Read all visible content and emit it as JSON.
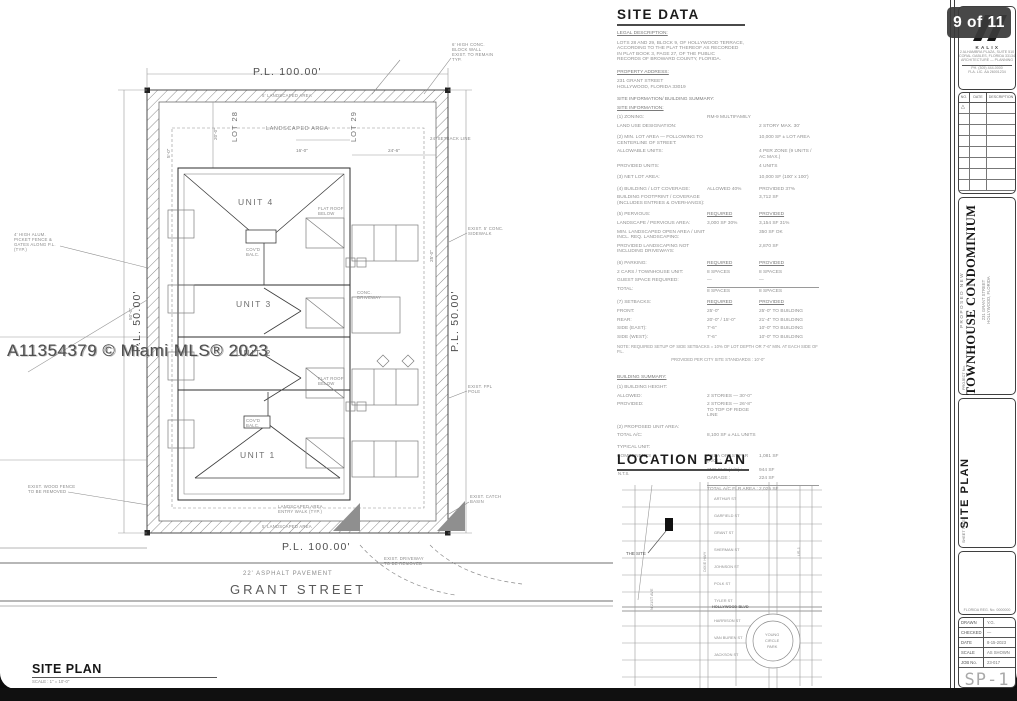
{
  "page": {
    "badge_label": "9 of 11",
    "watermark": "A11354379 © Miami MLS® 2023"
  },
  "site_plan": {
    "title": "SITE PLAN",
    "scale_note": "SCALE : 1\" = 10'-0\"",
    "pl_top": "P.L. 100.00'",
    "pl_bottom": "P.L. 100.00'",
    "pl_left": "P.L. 50.00'",
    "pl_right": "P.L. 50.00'",
    "lot_left": "LOT 28",
    "lot_right": "LOT 29",
    "landscaped_area_label": "LANDSCAPED AREA",
    "landscaped_top": "5' LANDSCAPED AREA",
    "landscaped_bottom": "5' LANDSCAPED AREA",
    "unit_labels": [
      "UNIT 4",
      "UNIT 3",
      "UNIT 2",
      "UNIT 1"
    ],
    "pavement_label": "22' ASPHALT PAVEMENT",
    "street_name": "GRANT STREET",
    "dimensions": [
      {
        "x": 213,
        "y": 140,
        "rot": -90,
        "t": "20'-0\""
      },
      {
        "x": 166,
        "y": 158,
        "rot": -90,
        "t": "5'-0\""
      },
      {
        "x": 388,
        "y": 148,
        "rot": 0,
        "t": "24'-6\""
      },
      {
        "x": 296,
        "y": 148,
        "rot": 0,
        "t": "16'-0\""
      },
      {
        "x": 429,
        "y": 262,
        "rot": -90,
        "t": "25'-0\""
      },
      {
        "x": 128,
        "y": 320,
        "rot": -90,
        "t": "50'-0\""
      }
    ],
    "annotations": [
      {
        "x": 452,
        "y": 42,
        "lines": [
          "6' HIGH CONC.",
          "BLOCK WALL",
          "EXIST. TO REMAIN",
          "TYP."
        ],
        "ldr": [
          451,
          58,
          424,
          94
        ]
      },
      {
        "x": 14,
        "y": 232,
        "lines": [
          "4' HIGH ALUM.",
          "PICKET FENCE &",
          "GATES ALONG P.L.",
          "(TYP.)"
        ],
        "ldr": [
          60,
          246,
          148,
          268
        ]
      },
      {
        "x": 468,
        "y": 226,
        "lines": [
          "EXIST. 5' CONC.",
          "SIDEWALK"
        ],
        "ldr": [
          467,
          233,
          449,
          242
        ]
      },
      {
        "x": 468,
        "y": 384,
        "lines": [
          "EXIST. FPL",
          "POLE"
        ],
        "ldr": [
          467,
          391,
          449,
          398
        ]
      },
      {
        "x": 470,
        "y": 494,
        "lines": [
          "EXIST. CATCH",
          "BASIN"
        ],
        "ldr": [
          469,
          502,
          449,
          514
        ]
      },
      {
        "x": 384,
        "y": 556,
        "lines": [
          "EXIST. DRIVEWAY",
          "TO BE REMOVED"
        ]
      },
      {
        "x": 278,
        "y": 504,
        "lines": [
          "LANDSCAPED AREA",
          "ENTRY WALK (TYP.)"
        ]
      },
      {
        "x": 357,
        "y": 290,
        "lines": [
          "CONC.",
          "DRIVEWAY"
        ]
      },
      {
        "x": 318,
        "y": 206,
        "lines": [
          "FLAT ROOF",
          "BELOW"
        ]
      },
      {
        "x": 318,
        "y": 376,
        "lines": [
          "FLAT ROOF",
          "BELOW"
        ]
      },
      {
        "x": 430,
        "y": 136,
        "lines": [
          "24' SETBACK LINE"
        ]
      },
      {
        "x": 246,
        "y": 247,
        "lines": [
          "COV'D",
          "BALC."
        ]
      },
      {
        "x": 246,
        "y": 418,
        "lines": [
          "COV'D",
          "BALC."
        ]
      },
      {
        "x": 28,
        "y": 484,
        "lines": [
          "EXIST. WOOD FENCE",
          "TO BE REMOVED"
        ],
        "ldr": [
          68,
          492,
          148,
          505
        ]
      }
    ]
  },
  "site_data": {
    "header": "SITE DATA",
    "legal_title": "LEGAL DESCRIPTION:",
    "legal_lines": [
      "LOTS 28 AND 29, BLOCK 9, OF HOLLYWOOD TERRACE,",
      "ACCORDING TO THE PLAT THEREOF AS RECORDED",
      "IN PLAT BOOK 3, PAGE 27, OF THE PUBLIC",
      "RECORDS OF BROWARD COUNTY, FLORIDA."
    ],
    "address_title": "PROPERTY ADDRESS:",
    "address_lines": [
      "231 GRANT STREET",
      "HOLLYWOOD, FLORIDA 33019"
    ],
    "summary_title": "SITE INFORMATION/ BUILDING SUMMARY:",
    "info_title": "SITE INFORMATION:",
    "rows": [
      {
        "l": "(1)  ZONING:",
        "m": "RM-9 MULTIFAMILY",
        "r": ""
      },
      {
        "l": "       LAND USE DESIGNATION:",
        "m": "",
        "r": "2 STORY MAX. 30'"
      },
      {
        "l": "(2)  MIN. LOT AREA — FOLLOWING TO CENTERLINE OF STREET:",
        "m": "",
        "r": "10,000 SF ± LOT AREA",
        "cls": "gap"
      },
      {
        "l": "       ALLOWABLE UNITS:",
        "m": "",
        "r": "4 PER ZONE (9 UNITS / AC MAX.)"
      },
      {
        "l": "       PROVIDED UNITS:",
        "m": "",
        "r": "4 UNITS"
      },
      {
        "l": "(3)  NET LOT AREA:",
        "m": "",
        "r": "10,000 SF  (100' x 100')",
        "cls": "gap"
      },
      {
        "l": "(4)  BUILDING / LOT COVERAGE:",
        "m": "ALLOWED  40%",
        "r": "PROVIDED  37%",
        "cls": "gap"
      },
      {
        "l": "       BUILDING FOOTPRINT / COVERAGE (INCLUDES ENTRIES & OVERHANGS):",
        "m": "",
        "r": "3,712 SF"
      },
      {
        "l": "(5)  PERVIOUS:",
        "m": "REQUIRED",
        "r": "PROVIDED",
        "cls": "hdr gap"
      },
      {
        "l": "       LANDSCAPE / PERVIOUS AREA:",
        "m": "3,000 SF  30%",
        "r": "3,154 SF  31%"
      },
      {
        "l": "       MIN. LANDSCAPED OPEN AREA / UNIT INCL. REQ. LANDSCAPING:",
        "m": "",
        "r": "350 SF   OK"
      },
      {
        "l": "       PROVIDED LANDSCAPING NOT INCLUDING DRIVEWAYS:",
        "m": "",
        "r": "2,870 SF"
      },
      {
        "l": "(6)  PARKING:",
        "m": "REQUIRED",
        "r": "PROVIDED",
        "cls": "hdr gap"
      },
      {
        "l": "       2 CARS / TOWNHOUSE UNIT:",
        "m": "8 SPACES",
        "r": "8 SPACES"
      },
      {
        "l": "       GUEST SPACE REQUIRED:",
        "m": "—",
        "r": "—"
      },
      {
        "l": "       TOTAL:",
        "m": "8 SPACES",
        "r": "8 SPACES",
        "cls": "tot"
      },
      {
        "l": "(7)  SETBACKS:",
        "m": "REQUIRED",
        "r": "PROVIDED",
        "cls": "hdr gap"
      },
      {
        "l": "       FRONT:",
        "m": "25'-0\"",
        "r": "25'-0\"   TO BUILDING"
      },
      {
        "l": "       REAR:",
        "m": "20'-0\" / 15'-0\"",
        "r": "21'-4\"   TO BUILDING"
      },
      {
        "l": "       SIDE (EAST):",
        "m": "7'-6\"",
        "r": "10'-0\"   TO BUILDING"
      },
      {
        "l": "       SIDE (WEST):",
        "m": "7'-6\"",
        "r": "10'-0\"   TO BUILDING"
      }
    ],
    "note1": "NOTE: REQUIRED SETUP OF SIDE SETBACKS = 10% OF LOT DEPTH OR 7'-6\" MIN. AT EACH SIDE OF P.L.",
    "note2": "PROVIDED PER CITY SITE STANDARDS : 10'-0\"",
    "building_title": "BUILDING SUMMARY:",
    "building_rows": [
      {
        "l": "(1)  BUILDING HEIGHT:",
        "m": "",
        "r": ""
      },
      {
        "l": "       ALLOWED:",
        "m": "2 STORIES — 30'-0\"",
        "r": ""
      },
      {
        "l": "       PROVIDED:",
        "m": "2 STORIES — 26'-8\" TO TOP OF RIDGE LINE",
        "r": ""
      },
      {
        "l": "(2)  PROPOSED UNIT AREA:",
        "m": "",
        "r": "",
        "cls": "gap"
      },
      {
        "l": "       TOTAL A/C:",
        "m": "8,100 SF ± ALL UNITS",
        "r": ""
      },
      {
        "l": "TYPICAL UNIT:",
        "m": "",
        "r": "",
        "cls": "gap"
      },
      {
        "l": "       COMPONENTS",
        "m": "AREA OF 1ST FLR (A/C) :",
        "r": "1,081 SF"
      },
      {
        "l": "",
        "m": "2ND FLR (A/C) :",
        "r": "944 SF"
      },
      {
        "l": "",
        "m": "GARAGE :",
        "r": "224 SF"
      },
      {
        "l": "",
        "m": "TOTAL A/C FLR AREA :",
        "r": "2,025 SF",
        "cls": "tot"
      }
    ]
  },
  "location_plan": {
    "header": "LOCATION PLAN",
    "scale": "N.T.S.",
    "site_label": "THE SITE",
    "streets": [
      "ARTHUR ST",
      "GARFIELD ST",
      "GRANT ST",
      "SHERMAN ST",
      "JOHNSON ST",
      "POLK ST",
      "TYLER ST",
      "HOLLYWOOD BLVD",
      "HARRISON ST",
      "VAN BUREN ST",
      "JACKSON ST"
    ],
    "v_streets": [
      {
        "x": 649,
        "y": 610,
        "t": "N 21ST AVE"
      },
      {
        "x": 702,
        "y": 572,
        "t": "DIXIE HWY"
      },
      {
        "x": 796,
        "y": 556,
        "t": "US-1"
      }
    ],
    "circle_lines": [
      "YOUNG",
      "CIRCLE",
      "PARK"
    ]
  },
  "title_block": {
    "firm_name": "K A L I X",
    "firm_lines": [
      "2 ALHAMBRA PLAZA, SUITE 510",
      "CORAL GABLES, FLORIDA 33134",
      "ARCHITECTURE — PLANNING"
    ],
    "firm_foot1": "PH. (305) 444-0000",
    "firm_foot2": "FLA. LIC. AA 26001234",
    "rev_headers": [
      "NO.",
      "DATE",
      "DESCRIPTION"
    ],
    "rev_delta": "△",
    "project_kicker": "PROPOSED  NEW",
    "project_title": "TOWNHOUSE CONDOMINIUM",
    "project_addr1": "231 GRANT STREET",
    "project_addr2": "HOLLYWOOD, FLORIDA",
    "project_tab": "PROJECT No.",
    "sheet_title": "SITE PLAN",
    "sheet_tab": "SHEET TITLE",
    "seal_note": "FLORIDA  REG. No. 0000000",
    "info_rows": [
      {
        "k": "DRAWN",
        "v": "Y.G."
      },
      {
        "k": "CHECKED",
        "v": "—"
      },
      {
        "k": "DATE",
        "v": "8-15-2023"
      },
      {
        "k": "SCALE",
        "v": "AS SHOWN"
      },
      {
        "k": "JOB No.",
        "v": "23-017"
      }
    ],
    "sheet_no": "SP-1",
    "sheet_of": "9   OF   11"
  }
}
